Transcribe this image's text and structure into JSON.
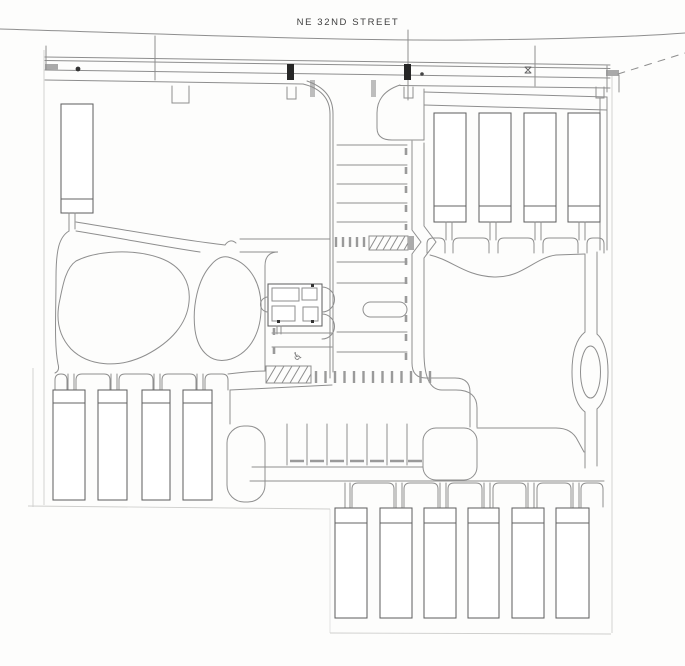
{
  "street": {
    "name": "NE 32ND STREET"
  },
  "symbols": {
    "accessible_parking": "♿"
  },
  "colors": {
    "paper": "#fdfdfc",
    "line": "#8e8e8e",
    "line-dark": "#636363",
    "line-faint": "#cfcfcd",
    "ink": "#404040",
    "fill-dark": "#262626",
    "curb-gray": "#ababab"
  }
}
